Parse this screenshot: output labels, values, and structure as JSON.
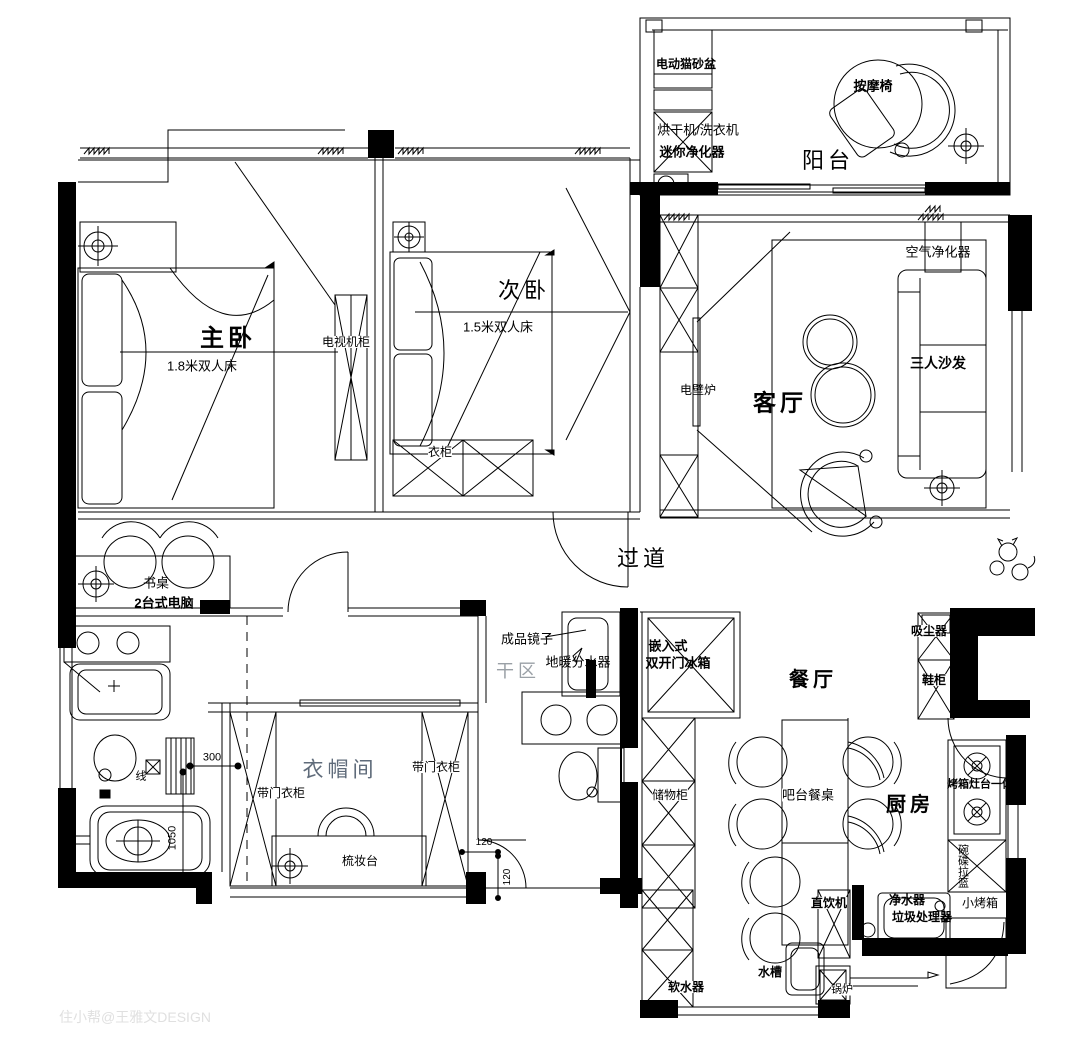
{
  "watermark": "住小帮@王雅文DESIGN",
  "colors": {
    "line": "#000000",
    "dry_area_text": "#9aa0a6",
    "cloak_text": "#5f6b7a",
    "watermark_text": "#e0e0e0"
  },
  "rooms": {
    "balcony": "阳台",
    "living_room": "客厅",
    "master_bedroom": "主卧",
    "second_bedroom": "次卧",
    "corridor": "过道",
    "dry_area": "干区",
    "cloakroom": "衣帽间",
    "dining_room": "餐厅",
    "kitchen": "厨房"
  },
  "items": {
    "cat_litter_box": "电动猫砂盆",
    "dryer_washer": "烘干机/洗衣机",
    "mini_purifier": "迷你净化器",
    "massage_chair": "按摩椅",
    "air_purifier": "空气净化器",
    "three_seat_sofa": "三人沙发",
    "electric_fireplace": "电壁炉",
    "tv_cabinet": "电视机柜",
    "bed_18": "1.8米双人床",
    "bed_15": "1.5米双人床",
    "wardrobe": "衣柜",
    "desk": "书桌",
    "two_desktop_pc": "2台式电脑",
    "finished_mirror": "成品镜子",
    "floor_heating_manifold": "地暖分水器",
    "fridge_line1": "嵌入式",
    "fridge_line2": "双开门冰箱",
    "vacuum_cleaner": "吸尘器",
    "shoe_cabinet": "鞋柜",
    "wardrobe_with_door_left": "带门衣柜",
    "wardrobe_with_door_right": "带门衣柜",
    "dressing_table": "梳妆台",
    "storage_cabinet": "储物柜",
    "bar_dining_table": "吧台餐桌",
    "oven_stove_combo": "烤箱灶台一体",
    "dish_pull_basket": "碗碟拉篮",
    "small_oven": "小烤箱",
    "water_purifier": "净水器",
    "garbage_disposal": "垃圾处理器",
    "drinking_machine": "直饮机",
    "sink": "水槽",
    "boiler": "锅炉",
    "water_softener": "软水器",
    "wire": "线"
  },
  "dimensions": {
    "d300": "300",
    "d1050": "1050",
    "d120a": "120",
    "d120b": "120"
  }
}
